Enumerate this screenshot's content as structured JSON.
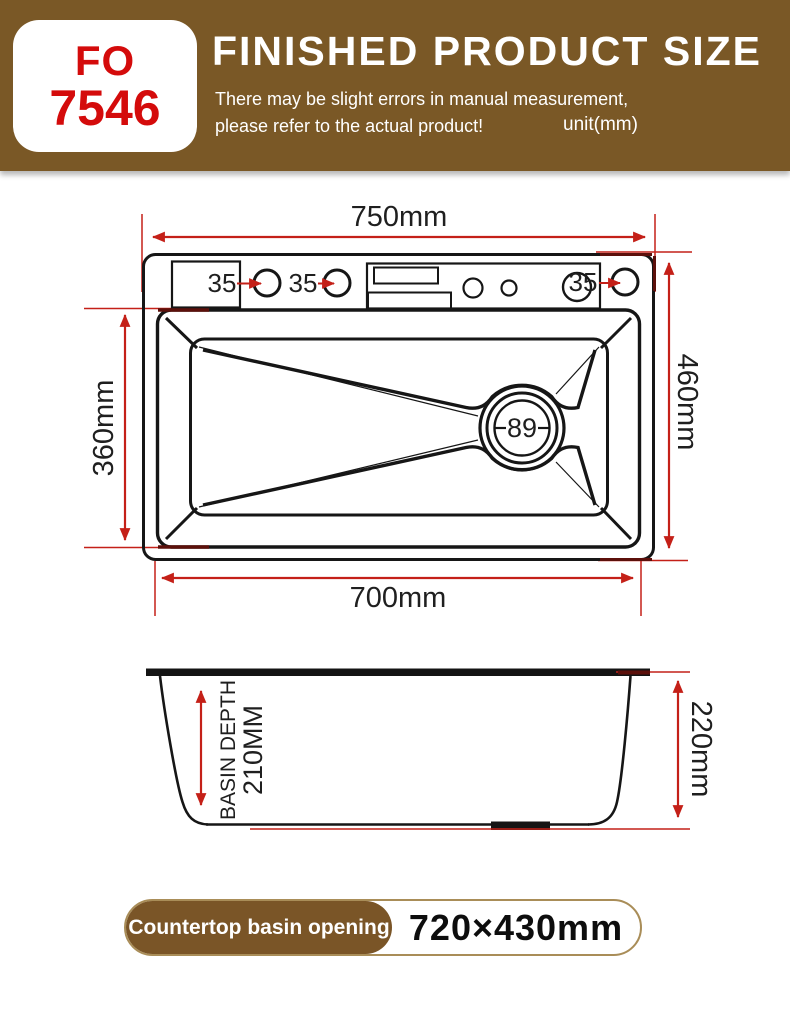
{
  "header": {
    "model": {
      "line1": "FO",
      "line2": "7546"
    },
    "title": "FINISHED PRODUCT SIZE",
    "note_line1": "There may be slight errors in manual measurement,",
    "note_line2": "please refer to the actual product!",
    "unit": "unit(mm)"
  },
  "top_view": {
    "overall_width": "750mm",
    "overall_depth": "460mm",
    "basin_opening_width": "700mm",
    "basin_opening_depth": "360mm",
    "hole_diameter_labels": [
      "35",
      "35",
      "35"
    ],
    "drain_diameter": "89"
  },
  "side_view": {
    "overall_height": "220mm",
    "basin_depth_line1": "BASIN DEPTH",
    "basin_depth_line2": "210MM"
  },
  "footer": {
    "label": "Countertop basin opening",
    "value": "720×430mm"
  },
  "colors": {
    "header_background": "#7a5826",
    "model_text": "#d40b0b",
    "dimension_red": "#c42018",
    "badge_brown": "#7a5527",
    "line_black": "#161616"
  }
}
